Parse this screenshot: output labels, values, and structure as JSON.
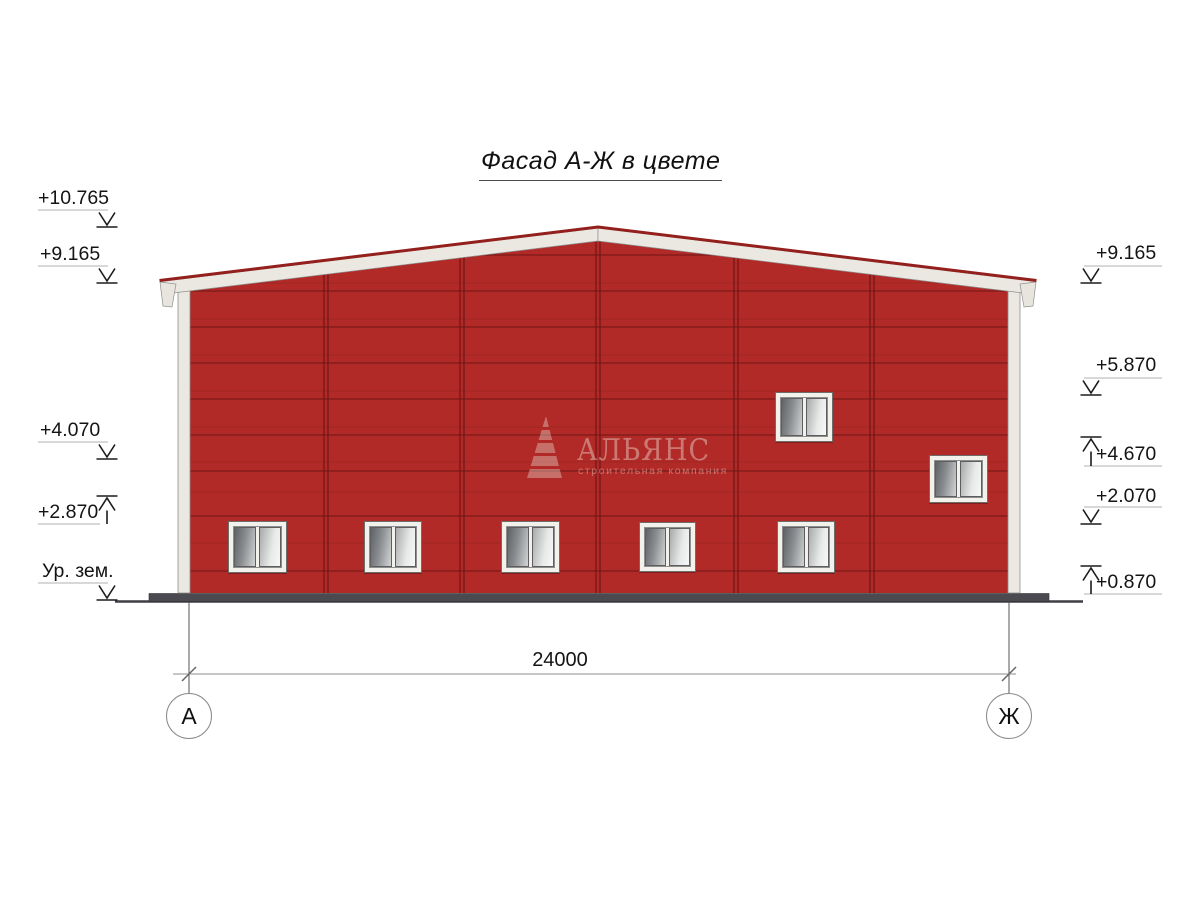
{
  "title": {
    "text": "Фасад А-Ж в цвете"
  },
  "elevation_marks": {
    "left": [
      {
        "label": "+10.765",
        "direction": "down"
      },
      {
        "label": "+9.165",
        "direction": "down"
      },
      {
        "label": "+4.070",
        "direction": "down"
      },
      {
        "label": "+2.870",
        "direction": "up"
      },
      {
        "label": "Ур. зем.",
        "direction": "down"
      }
    ],
    "right": [
      {
        "label": "+9.165",
        "direction": "down"
      },
      {
        "label": "+5.870",
        "direction": "down"
      },
      {
        "label": "+4.670",
        "direction": "up"
      },
      {
        "label": "+2.070",
        "direction": "down"
      },
      {
        "label": "+0.870",
        "direction": "up"
      }
    ]
  },
  "dimension": {
    "value": "24000"
  },
  "axes": {
    "left": "А",
    "right": "Ж"
  },
  "watermark": {
    "name": "АЛЬЯНС",
    "tagline": "строительная компания",
    "icon": "stepped-pyramid-icon"
  },
  "building": {
    "wall_color": "#B22A28",
    "panel_joint_color": "#7D1A18",
    "trim_color": "#EAE8E0",
    "roof_edge_color": "#93201C",
    "plinth_color": "#4A4A50",
    "bays": 6,
    "windows_bottom_row": 5,
    "windows_upper": 2
  }
}
